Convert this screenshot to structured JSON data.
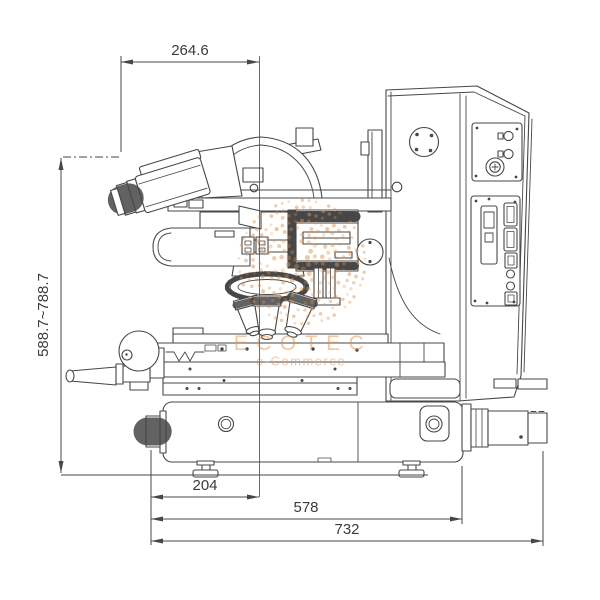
{
  "figure": {
    "type": "technical-dimension-drawing",
    "subject": "measuring microscope side view",
    "background_color": "#ffffff",
    "line_color": "#474747",
    "text_color": "#3b3b3b"
  },
  "dimensions": {
    "top_width": "264.6",
    "height_range": "588.7~788.7",
    "stage_axis_offset": "204",
    "base_depth": "578",
    "overall_depth": "732"
  },
  "watermark": {
    "title": "ECOTEC",
    "subtitle": "e-Commerce",
    "color": "#e2924a"
  }
}
